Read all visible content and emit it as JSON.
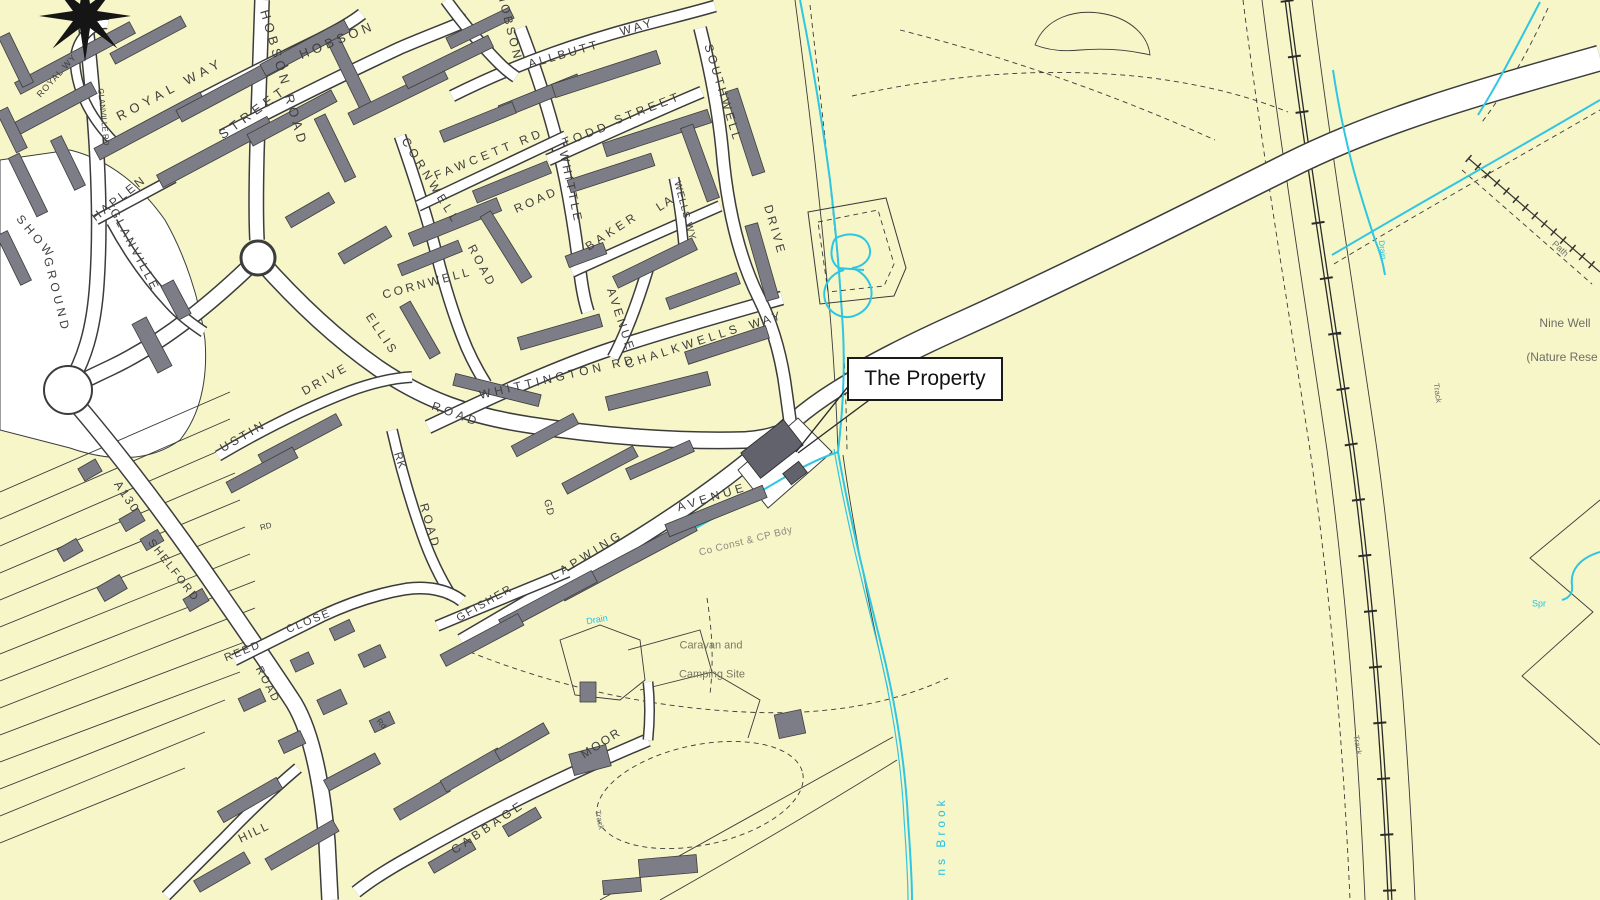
{
  "meta": {
    "kind": "os-style-location-plan"
  },
  "callout": {
    "text": "The Property"
  },
  "colors": {
    "background": "#f6f6c8",
    "road_fill": "#ffffff",
    "road_casing": "#3c3c3c",
    "building": "#7d7d87",
    "building_outline": "#3e3e3e",
    "property_building": "#62626c",
    "water": "#2fc6e2",
    "water_label": "#1ec3e8",
    "label": "#3f3f3f"
  },
  "streets": {
    "royal_wy": "ROYAL WY",
    "glanville_rd": "GLANVILLE RD",
    "royal_way": "ROYAL WAY",
    "hobson": "HOBSON",
    "hobson_street": "STREET",
    "hobson_road": "HOBSON ROAD",
    "hobson_upper": "HOBSON",
    "haplen": "HAPLEN",
    "glanville": "GLANVILLE",
    "cornwell": "CORNWELL",
    "cornwell_road": "ROAD",
    "cornwell_lower": "CORNWELL",
    "fawcett_rd": "FAWCETT RD",
    "allbutt": "ALLBUTT",
    "allbutt_way": "WAY",
    "todd": "TODD",
    "todd_street": "STREET",
    "southwell": "SOUTHWELL",
    "southwell_drive": "DRIVE",
    "whittle": "WHITTLE",
    "whittle_road": "ROAD",
    "baker": "BAKER",
    "baker_la": "LA",
    "wells_wy": "WELLS WY",
    "avenue": "AVENUE",
    "whittington_rd": "WHITTINGTON RD",
    "chalkwells": "CHALKWELLS",
    "chalkwells_way": "WAY",
    "ellis": "ELLIS",
    "ellis_road": "ROAD",
    "austin": "USTIN",
    "austin_drive": "DRIVE",
    "rk": "RK",
    "rk_road": "ROAD",
    "gd": "GD",
    "kingfisher": "GFISHER",
    "lapwing": "LAPWING",
    "lapwing_avenue": "AVENUE",
    "a130": "A130",
    "shelford": "SHELFORD",
    "shelford_road": "ROAD",
    "reed": "REED",
    "reed_close": "CLOSE",
    "rd_abbrev": "RD",
    "rd_abbrev2": "Rd",
    "hill": "HILL",
    "cabbage": "CABBAGE",
    "moor": "MOOR"
  },
  "features": {
    "show": "SHOW",
    "ground": "GROUND",
    "co_const_cp_bdy": "Co Const & CP Bdy",
    "caravan_line1": "Caravan and",
    "caravan_line2": "Camping Site",
    "nine_well": "Nine Well",
    "nature_reserve": "(Nature Rese",
    "track_moor": "Track",
    "track_rail": "Track",
    "track_ne": "Track",
    "path_ne": "Path"
  },
  "water": {
    "drain_sw": "Drain",
    "drain_ne": "Drain",
    "spr": "Spr",
    "brook": "ns Brook"
  }
}
